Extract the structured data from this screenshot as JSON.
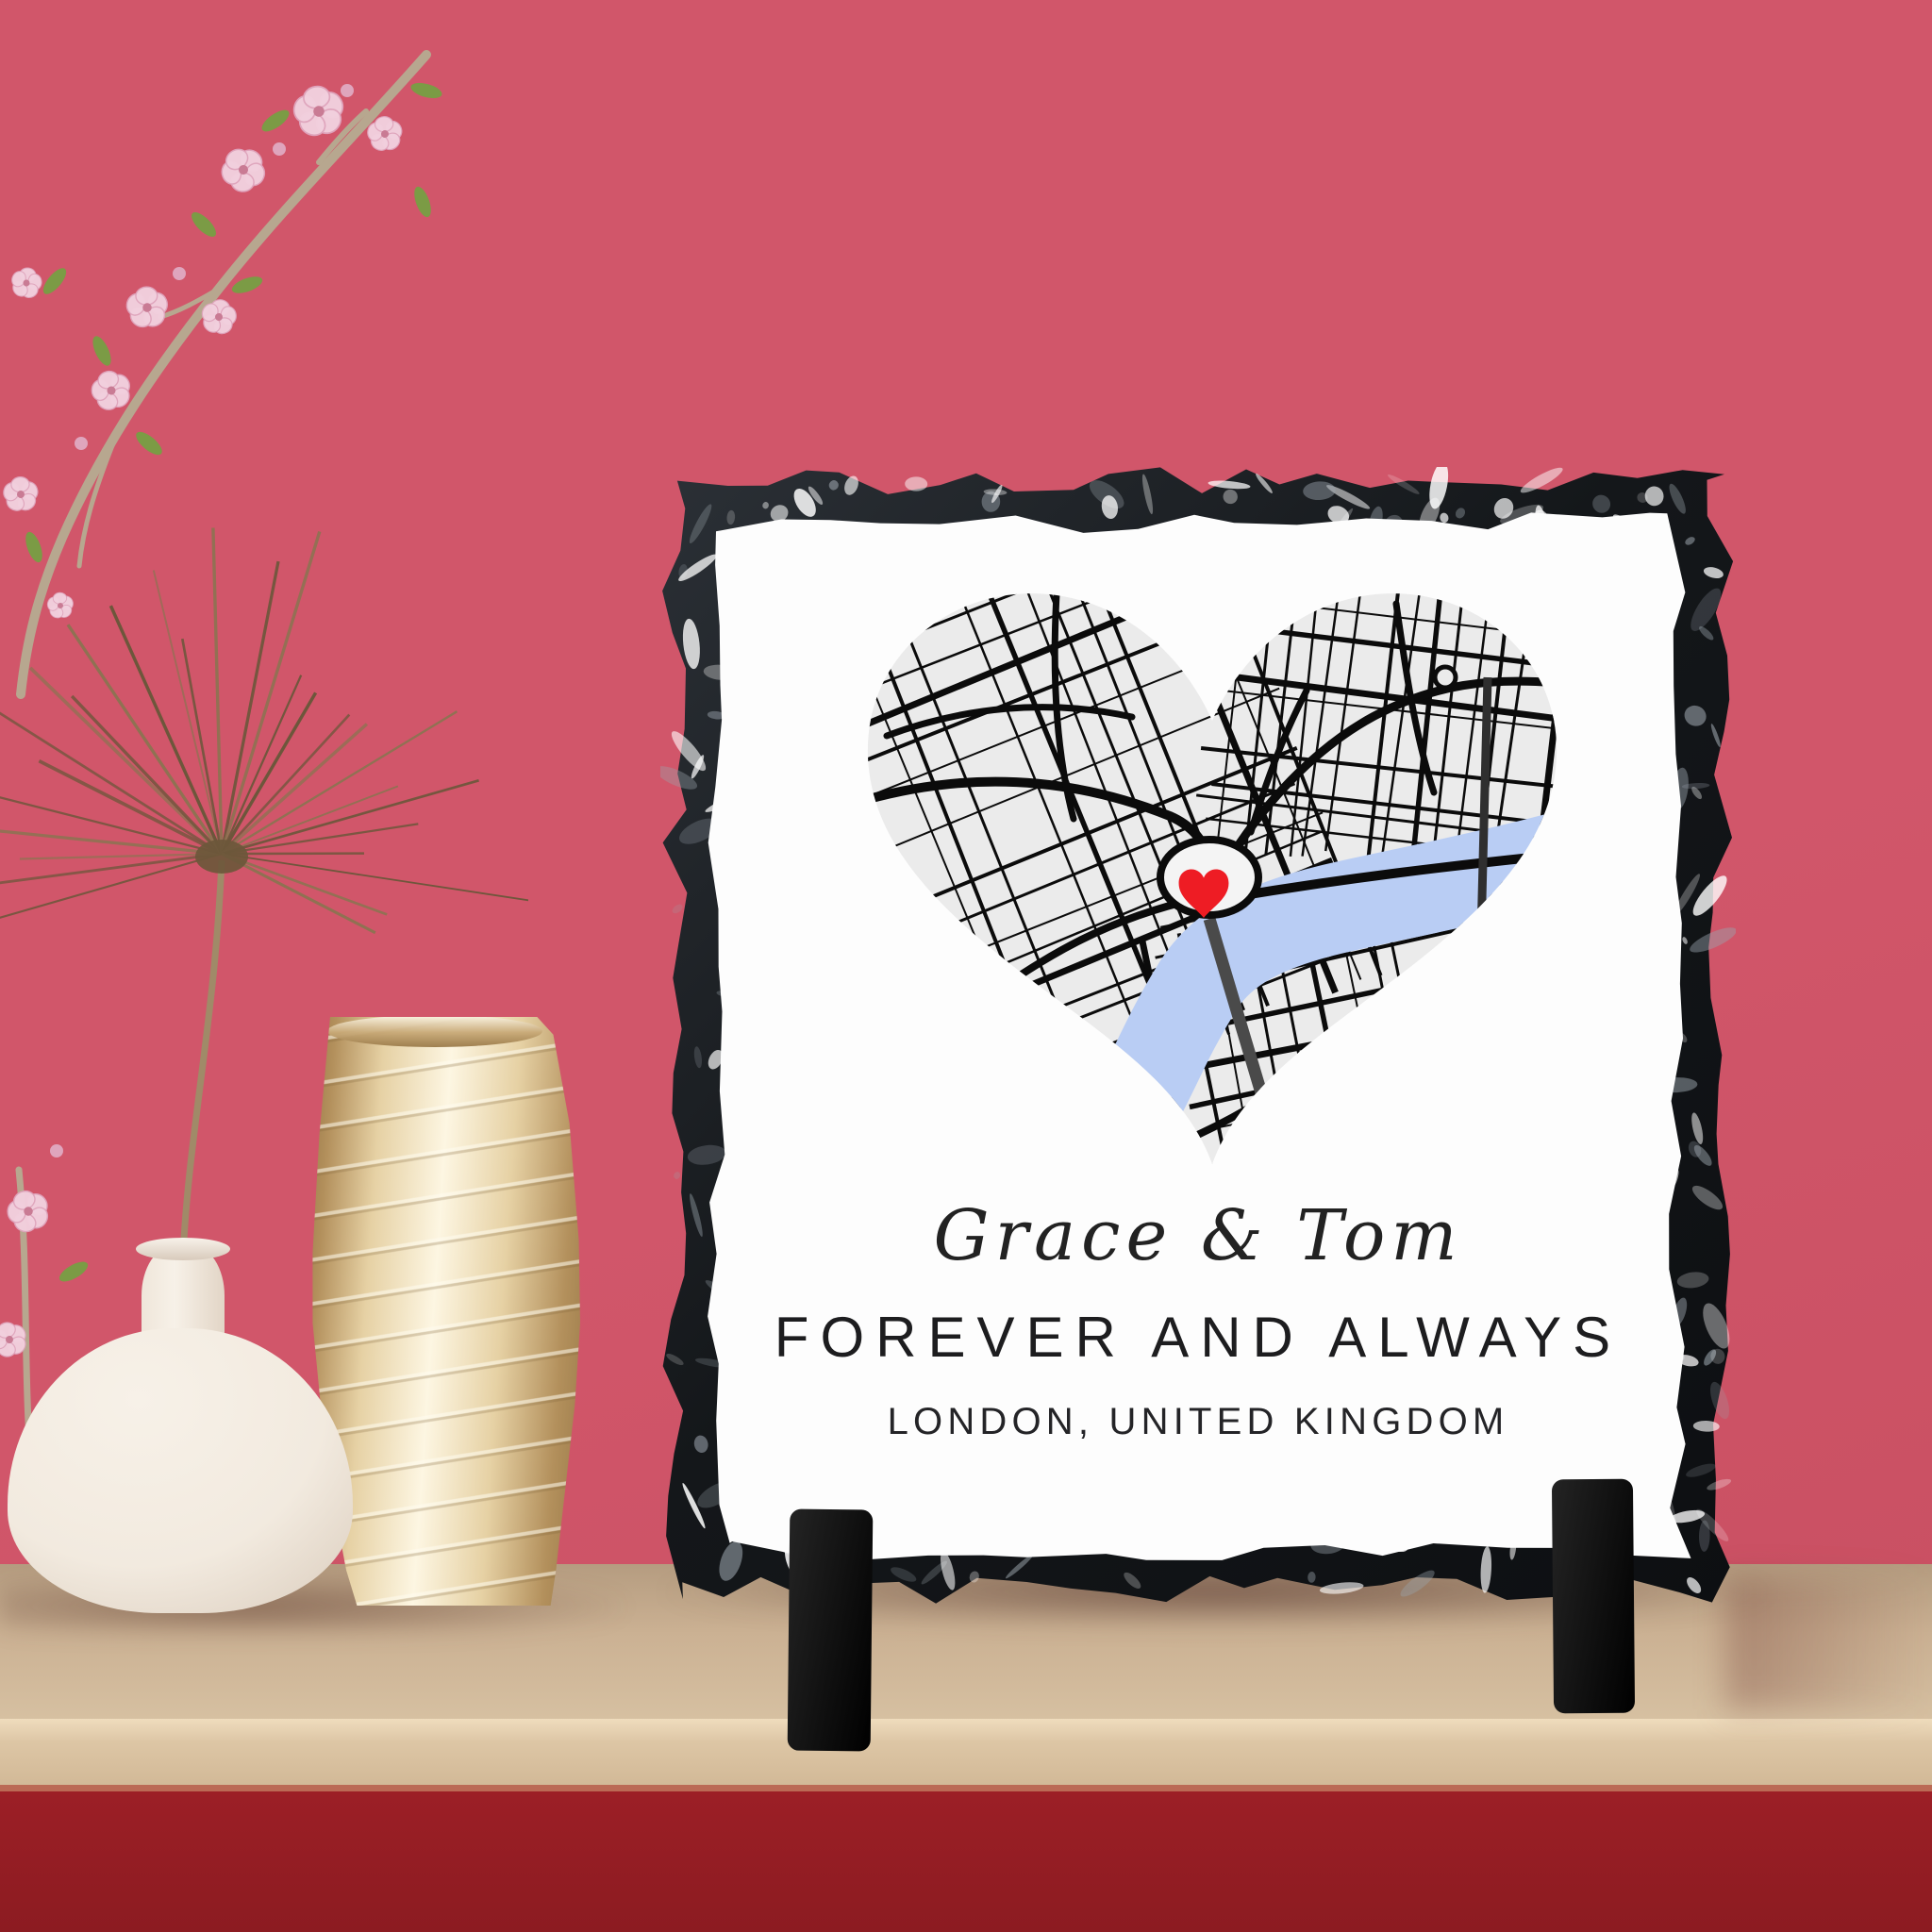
{
  "scene_type": "product photo of a personalised slate map tile on a shelf",
  "tile": {
    "names": "Grace & Tom",
    "headline": "FOREVER AND ALWAYS",
    "location": "LONDON, UNITED KINGDOM",
    "marker_icon": "heart-marker"
  },
  "colors": {
    "wall": "#d1566a",
    "wall_deep": "#c74e60",
    "shelf_top": "#cbb193",
    "shelf_top_dark": "#b59c80",
    "shelf_front": "#ddc6a5",
    "shelf_front_hi": "#efdcbd",
    "shelf_edge": "#bb6a55",
    "under_shelf": "#9c1f26",
    "under_shelf_deep": "#8c1b21",
    "slate_dark": "#0d0f12",
    "slate_mid": "#2b3036",
    "slate_speck": "#9aa4ac",
    "tile_face": "#fdfdfd",
    "map_land": "#ebebeb",
    "map_road": "#0b0b0b",
    "river": "#b9cdf4",
    "bridge": "#4a4a4a",
    "bridge2": "#2f2f2f",
    "ring_fill": "#f4f4f4",
    "marker_red": "#ee1c24",
    "text_dark": "#1d1d1f",
    "foot": "#141414",
    "vase_white": "#f2eadf",
    "vase_white_shade": "#cdbfb0",
    "gold_hi": "#fdf6e2",
    "gold_mid": "#e6d1a4",
    "gold_dark": "#b3905c",
    "gold_edge": "#9a7a49",
    "blossom": "#f2d0de",
    "blossom_deep": "#dfa5bd",
    "blossom_center": "#c97b94",
    "leaf": "#7b9b45",
    "branch": "#b7a78f",
    "frond": "#8d7352",
    "frond_dark": "#6c573b"
  }
}
